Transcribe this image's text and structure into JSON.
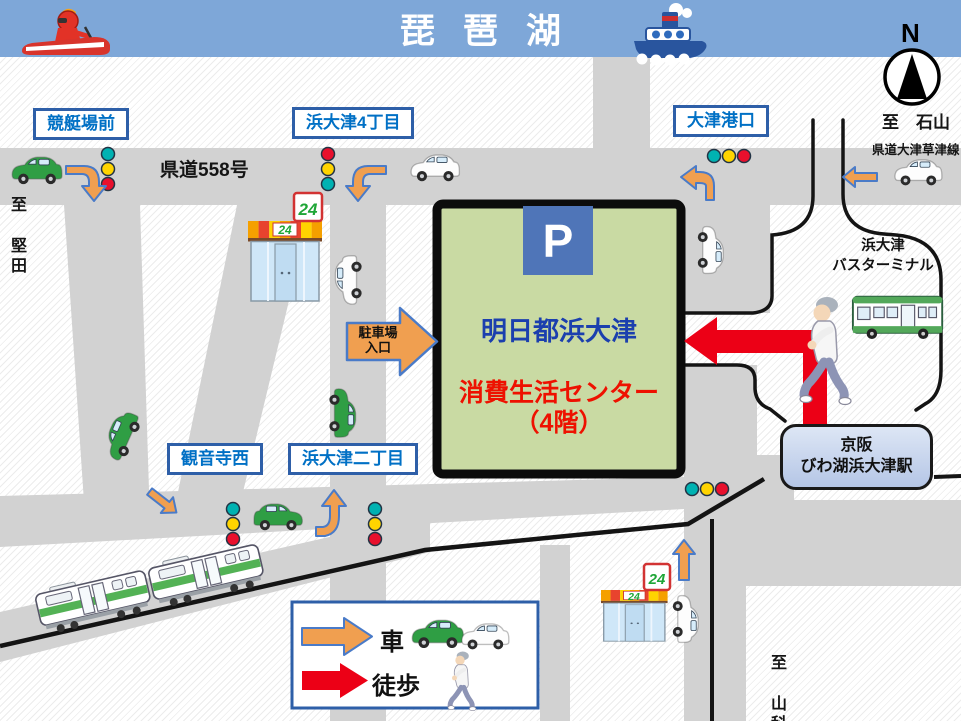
{
  "banner": {
    "title": "琵琶湖"
  },
  "compass": {
    "n": "N"
  },
  "roads": {
    "route_558": "県道558号",
    "route_otsu_kusatsu": "県道大津草津線"
  },
  "directions": {
    "to_katata": "至 堅田",
    "to_ishiyama": "至　石山",
    "to_yamashina": "至 山科"
  },
  "intersections": {
    "keiteijo_mae": "競艇場前",
    "hamaotsu_4chome": "浜大津4丁目",
    "otsu_ko_guchi": "大津港口",
    "kannonji_nishi": "観音寺西",
    "hamaotsu_2chome": "浜大津二丁目"
  },
  "building": {
    "parking_mark": "P",
    "name": "明日都浜大津",
    "department": "消費生活センター",
    "floor": "（4階）"
  },
  "parking_entrance": {
    "line1": "駐車場",
    "line2": "入口"
  },
  "bus_terminal": {
    "line1": "浜大津",
    "line2": "バスターミナル"
  },
  "station": {
    "line1": "京阪",
    "line2": "びわ湖浜大津駅"
  },
  "legend": {
    "car": "車",
    "walk": "徒歩"
  },
  "store": {
    "sign": "24"
  },
  "colors": {
    "banner_blue": "#7ea7d8",
    "road_gray": "#d2d2d2",
    "building_green": "#c9daa3",
    "name_blue": "#1b3fae",
    "alert_red": "#ee1100",
    "route_orange": "#f09f50",
    "walk_red": "#ec0016",
    "label_blue": "#0070c5",
    "accent_blue": "#2e5fa8"
  }
}
